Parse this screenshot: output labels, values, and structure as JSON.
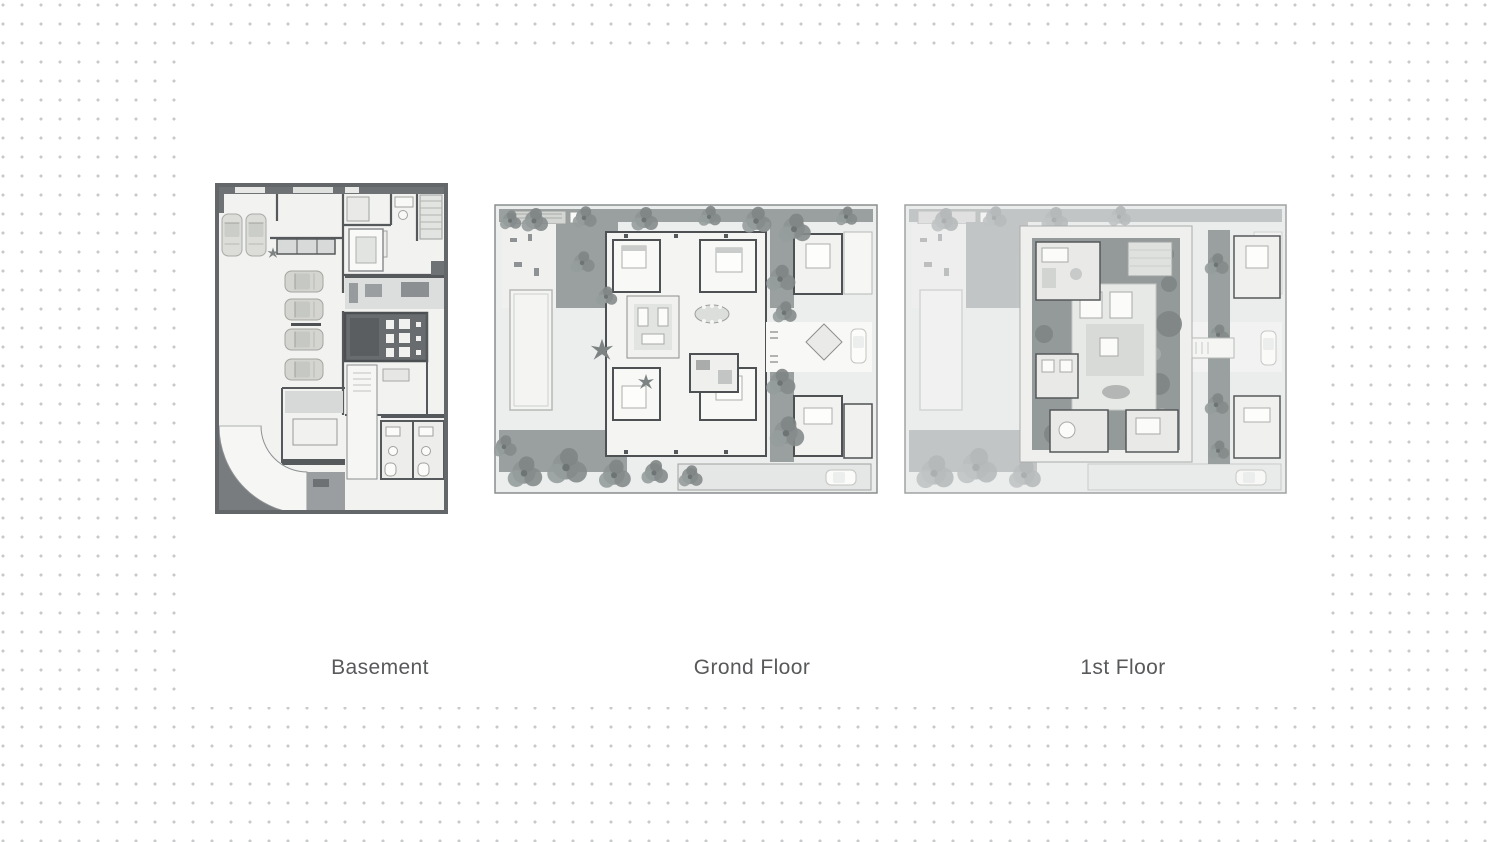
{
  "floor_plans": [
    {
      "id": "basement",
      "label": "Basement",
      "image": "basement-floor-plan-image"
    },
    {
      "id": "ground",
      "label": "Grond Floor",
      "image": "ground-floor-plan-image"
    },
    {
      "id": "first",
      "label": "1st Floor",
      "image": "first-floor-plan-image"
    }
  ],
  "palette": {
    "page_background": "#ffffff",
    "dot_color": "#c7c9ca",
    "label_text_color": "#58595b",
    "plan_wall_dark": "#55585a",
    "plan_border_dark": "#646769",
    "plan_garden_gray": "#9aa0a0",
    "plan_floor_light": "#f2f2f0",
    "theater_room_gray": "#696c6e"
  }
}
